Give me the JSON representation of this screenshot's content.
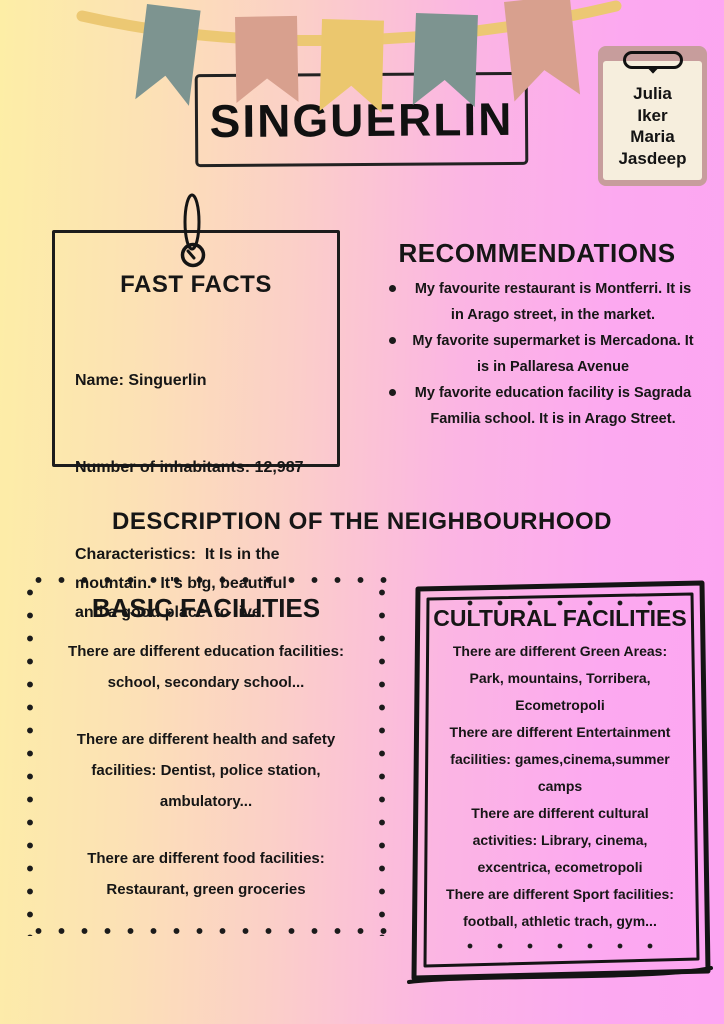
{
  "poster": {
    "title": "SINGUERLIN",
    "clipboard": {
      "authors": [
        "Julia",
        "Iker",
        "Maria",
        "Jasdeep"
      ]
    },
    "fast_facts": {
      "title": "FAST FACTS",
      "lines": [
        "Name: Singuerlin",
        "Number of inhabitants: 12,987",
        "Characteristics:  It Is in the\nmountain.  It's big, beautiful\nand a good place  to live."
      ]
    },
    "recommendations": {
      "title": "RECOMMENDATIONS",
      "items": [
        "My favourite restaurant is Montferri. It is\nin Arago street, in the market.",
        "My favorite supermarket is Mercadona. It\nis in Pallaresa Avenue",
        "My favorite education facility is Sagrada\nFamilia school. It is in Arago Street."
      ]
    },
    "description_heading": "DESCRIPTION OF THE NEIGHBOURHOOD",
    "basic_facilities": {
      "title": "BASIC FACILITIES",
      "paragraphs": [
        "There are different education facilities:\nschool, secondary school...",
        "There are different health and safety\nfacilities: Dentist, police station,\nambulatory...",
        "There are different food facilities:\nRestaurant, green groceries"
      ]
    },
    "cultural_facilities": {
      "title": "CULTURAL FACILITIES",
      "paragraphs": [
        "There are different Green Areas:\nPark, mountains, Torribera,\nEcometropoli",
        "There are different Entertainment\nfacilities: games,cinema,summer\ncamps",
        "There are different cultural\nactivities: Library, cinema,\nexcentrica, ecometropoli",
        "There are different Sport facilities:\nfootball, athletic trach, gym..."
      ]
    },
    "colors": {
      "background_left": "#fdeea6",
      "background_right": "#fda6f2",
      "flag_teal": "#7d9490",
      "flag_salmon": "#d8a08e",
      "flag_yellow": "#ebc76e",
      "rope": "#ecc873",
      "clipboard_board": "#c79d9c",
      "clipboard_paper": "#f6eedd",
      "ink": "#1b1b1b"
    }
  }
}
